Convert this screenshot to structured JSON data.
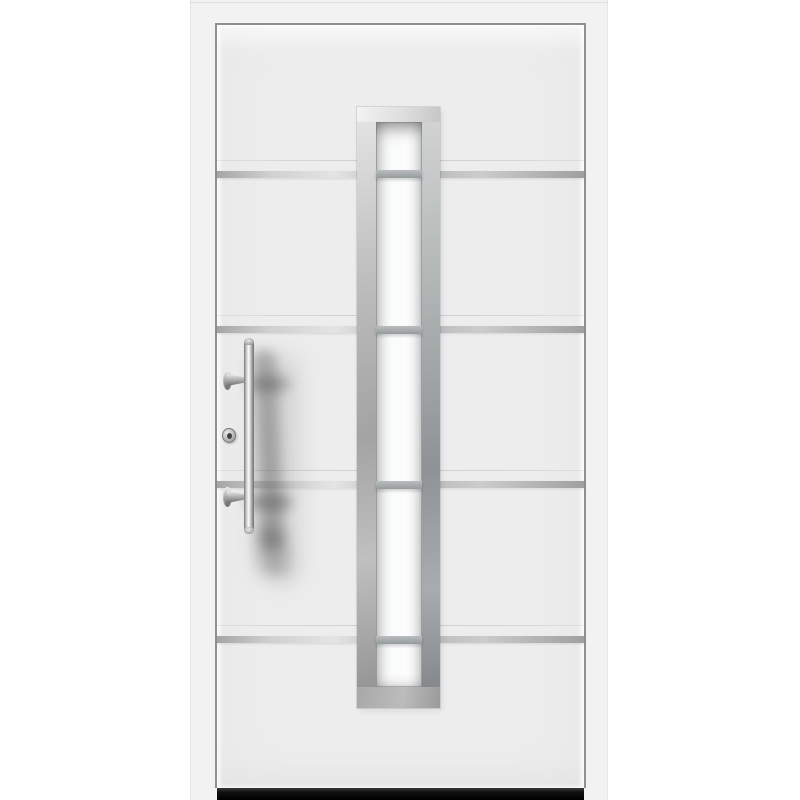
{
  "meta": {
    "description": "Product photograph of a white aluminium front entry door with a tall central glazing strip, four horizontal stainless-steel trim stripes, a vertical stainless bar handle, a profile cylinder lock and a dark threshold.",
    "background": "#ffffff"
  },
  "palette": {
    "background": "#ffffff",
    "frame": "#f2f2f3",
    "leaf": "#ededee",
    "leaf_edge": "#8f9092",
    "stripe_light": "#e4e4e4",
    "stripe_dark": "#a0a0a0",
    "glazing_steel_light": "#e6e6e6",
    "glazing_steel_dark": "#7d8183",
    "glass": "#fdfdfd",
    "glass_crossbar": "#9ba0a2",
    "handle_steel_light": "#fbfbfb",
    "handle_steel_dark": "#6d6d6d",
    "threshold": "#101010"
  },
  "door": {
    "stripes": [
      {
        "y": 171
      },
      {
        "y": 326
      },
      {
        "y": 481
      },
      {
        "y": 636
      }
    ],
    "glazing": {
      "crossbars": [
        {
          "y": 170
        },
        {
          "y": 326
        },
        {
          "y": 481
        },
        {
          "y": 636
        }
      ]
    },
    "hardware": [
      {
        "name": "stainless-bar-handle"
      },
      {
        "name": "profile-cylinder-lock"
      },
      {
        "name": "threshold-sill"
      }
    ]
  }
}
